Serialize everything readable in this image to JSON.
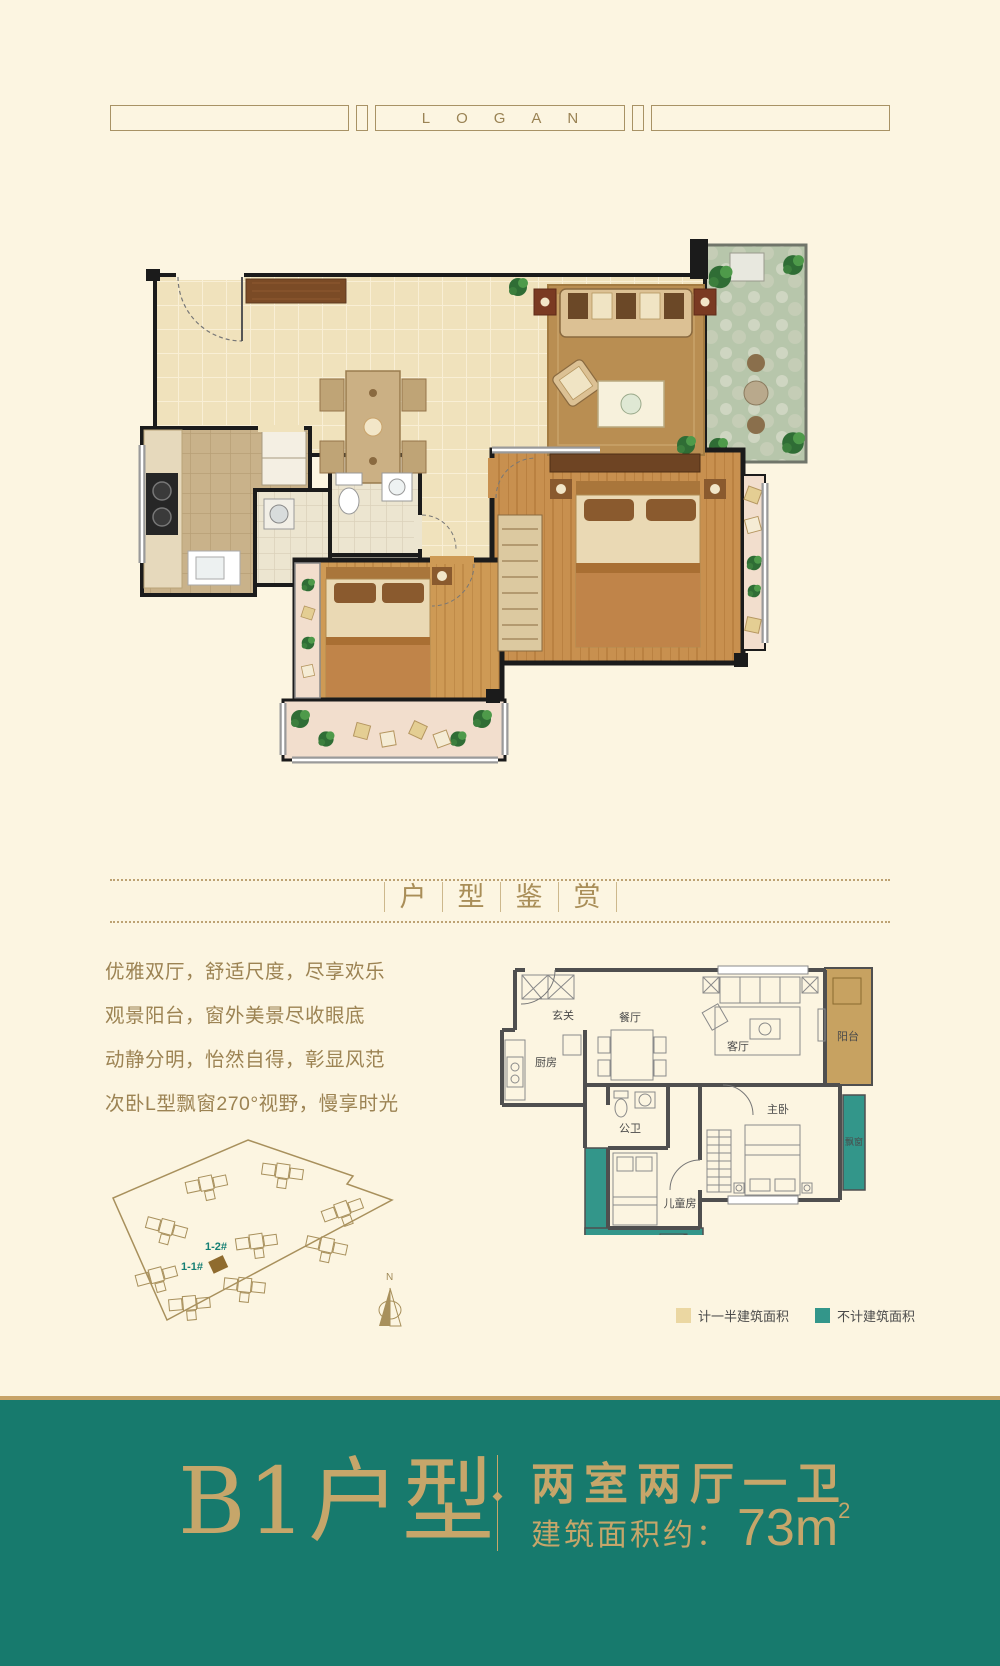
{
  "header": {
    "logo": "LOGAN"
  },
  "section_title": {
    "chars": [
      "户",
      "型",
      "鉴",
      "赏"
    ]
  },
  "description": {
    "lines": [
      "优雅双厅，舒适尺度，尽享欢乐",
      "观景阳台，窗外美景尽收眼底",
      "动静分明，怡然自得，彰显风范",
      "次卧L型飘窗270°视野，慢享时光"
    ]
  },
  "site_plan": {
    "building_1": "1-1#",
    "building_2": "1-2#",
    "compass": "N"
  },
  "diagram": {
    "entry": "玄关",
    "dining": "餐厅",
    "kitchen": "厨房",
    "living": "客厅",
    "bath": "公卫",
    "master": "主卧",
    "kids": "儿童房",
    "balcony": "阳台",
    "bay_right": "飘窗",
    "bay_bottom": "飘窗"
  },
  "legend": {
    "half_area": {
      "label": "计一半建筑面积",
      "color": "#EBD7A2"
    },
    "excluded": {
      "label": "不计建筑面积",
      "color": "#33968A"
    }
  },
  "footer": {
    "unit": "B1户型",
    "rooms": "两室两厅一卫",
    "area_label": "建筑面积约：",
    "area_value": "73m",
    "area_sup": "2",
    "band_color": "#177A6D",
    "gold_color": "#C6A66A"
  }
}
